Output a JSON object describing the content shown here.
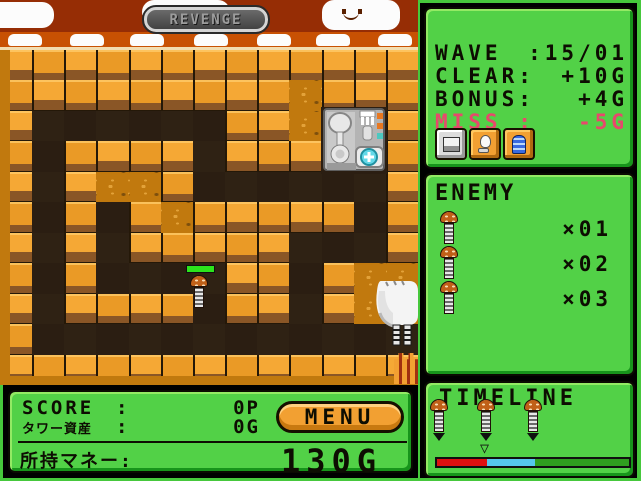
{
  "map": {
    "banner_label": "REVENGE",
    "tiles": [
      "WWWWWWWWWWWWW",
      "WWWWWWWWWDWWW",
      "WPPPPPPWWDPPW",
      "WPWWWWPWWWPPW",
      "WPWDDWPPPPPPW",
      "WPWPWDWWWWWPW",
      "WPWPWWWWWPPPW",
      "WPWPPPPWWPWDD",
      "WPWWWWPWWPWDD",
      "WPPPPPPPPPPPP",
      "WWWWWWWWWWWWW"
    ]
  },
  "hud": {
    "wave_label": "WAVE",
    "wave_value": ":15/01",
    "clear_label": "CLEAR:",
    "clear_value": "+10G",
    "bonus_label": "BONUS:",
    "bonus_value": "+4G",
    "miss_label": "MISS :",
    "miss_value": "-5G"
  },
  "enemy_panel": {
    "title": "ENEMY",
    "rows": [
      {
        "count": "×01"
      },
      {
        "count": "×02"
      },
      {
        "count": "×03"
      }
    ]
  },
  "timeline_panel": {
    "title": "TIMELINE",
    "bar": {
      "red_pct": 26,
      "blue_pct": 25,
      "green_pct": 49
    },
    "bar_colors": {
      "red": "#e01010",
      "blue": "#55c8ec",
      "green": "#2f9e1f"
    }
  },
  "score_panel": {
    "score_label": "SCORE",
    "score_sep": ":",
    "score_value": "0P",
    "assets_label": "タワー資産",
    "assets_sep": ":",
    "assets_value": "0G",
    "menu_label": "MENU",
    "money_label": "所持マネー:",
    "money_value": "130G"
  },
  "colors": {
    "panel_green": "#52d147",
    "panel_green_light": "#93ea64",
    "panel_green_dark": "#17941b",
    "miss_pink": "#e8486c",
    "health_green": "#2ce41c",
    "brick_orange": "#f2a032",
    "path_dark": "#2b1e12"
  }
}
